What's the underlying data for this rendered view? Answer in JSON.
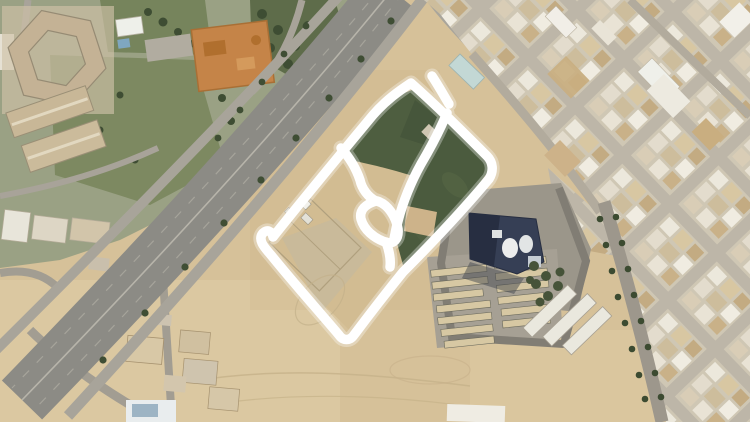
{
  "scene": {
    "kind": "satellite-aerial-photo",
    "features": [
      "hand-drawn white annotation outlining a walled compound with two green fields",
      "diagonal multi-lane highway with service roads and tree rows",
      "hexagonal campus building and green park upper-left",
      "orange playground court",
      "dense rotated residential city grid on right half",
      "dark navy institutional building with white rooftop tanks",
      "rows of tan barracks buildings on asphalt pad",
      "white warehouse buildings and tree-lined street lower-right",
      "open sand lots at bottom"
    ]
  },
  "colors": {
    "sand": "#d6c199",
    "sand_light": "#e3d0ab",
    "compound_sand": "#d2bc92",
    "field_green_a": "#4e5e40",
    "field_green_b": "#4b5b3e",
    "park_base": "#9aa184",
    "lawn": "#7d8961",
    "grove": "#5e6c4a",
    "tree": "#3e4d33",
    "highway": "#8c8b85",
    "service_road": "#a8a49a",
    "city_street": "#b2ab9d",
    "city_block": "#cfc7b4",
    "building_white": "#eeeadf",
    "building_tan": "#d8c7a2",
    "building_brown": "#c3aa81",
    "asphalt_pad": "#9b968a",
    "navy_building": "#363f55",
    "navy_dark": "#272e41",
    "barracks": "#d7c8a3",
    "warehouse": "#eae8de",
    "playground": "#c58448",
    "annotation": "#ffffff"
  },
  "annotation": {
    "stroke_color": "#ffffff",
    "stroke_width": 9.5,
    "halo_width": 15,
    "paths": {
      "outline": "M411,83 C437,106 462,131 487,156 C493,162 494,171 489,179 C463,210 432,243 403,272 C386,293 369,315 354,335 C350,341 343,341 339,335 C316,308 292,281 271,255 C265,248 257,240 263,233 C267,229 272,231 273,237 C304,198 339,156 373,115 C386,100 399,91 411,83 Z",
      "divider": "M447,113 C440,130 431,147 421,164 C411,182 403,202 398,221 C396,228 395,234 394,239",
      "left_branch": "M341,148 C349,157 356,168 360,180 C362,189 368,197 376,201",
      "loop": "M376,201 C366,204 359,210 361,219 C364,230 374,238 385,242 C394,245 399,239 398,229 C396,217 388,204 377,201 Z",
      "tail": "M386,242 C389,250 391,259 390,267",
      "flick": "M432,76 C438,85 443,94 449,104"
    }
  }
}
